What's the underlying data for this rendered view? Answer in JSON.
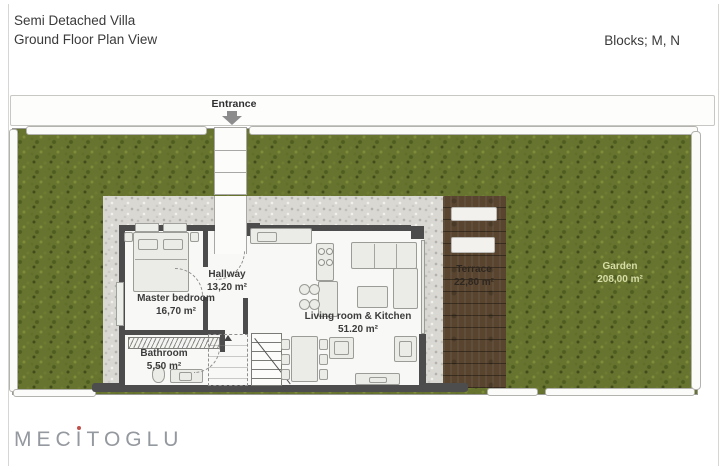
{
  "header": {
    "title_line1": "Semi Detached Villa",
    "title_line2": "Ground Floor Plan View",
    "blocks_label": "Blocks; M, N"
  },
  "plan": {
    "entrance_label": "Entrance",
    "rooms": {
      "master_bedroom": {
        "name": "Master bedroom",
        "area": "16,70 m²"
      },
      "hallway": {
        "name": "Hallway",
        "area": "13,20 m²"
      },
      "bathroom": {
        "name": "Bathroom",
        "area": "5,50 m²"
      },
      "living_kitchen": {
        "name": "Living room & Kitchen",
        "area": "51.20 m²"
      },
      "terrace": {
        "name": "Terrace",
        "area": "22,80 m²"
      },
      "garden": {
        "name": "Garden",
        "area": "208,00 m²"
      }
    },
    "colors": {
      "grass": "#67742f",
      "gravel": "#dad8d3",
      "wall": "#4c4c4c",
      "terrace_wood": "#59452f",
      "logo_gray": "#94989f",
      "logo_accent_red": "#c0504c"
    }
  },
  "footer": {
    "logo_part1": "MEC",
    "logo_i": "I",
    "logo_part2": "TOGLU"
  }
}
